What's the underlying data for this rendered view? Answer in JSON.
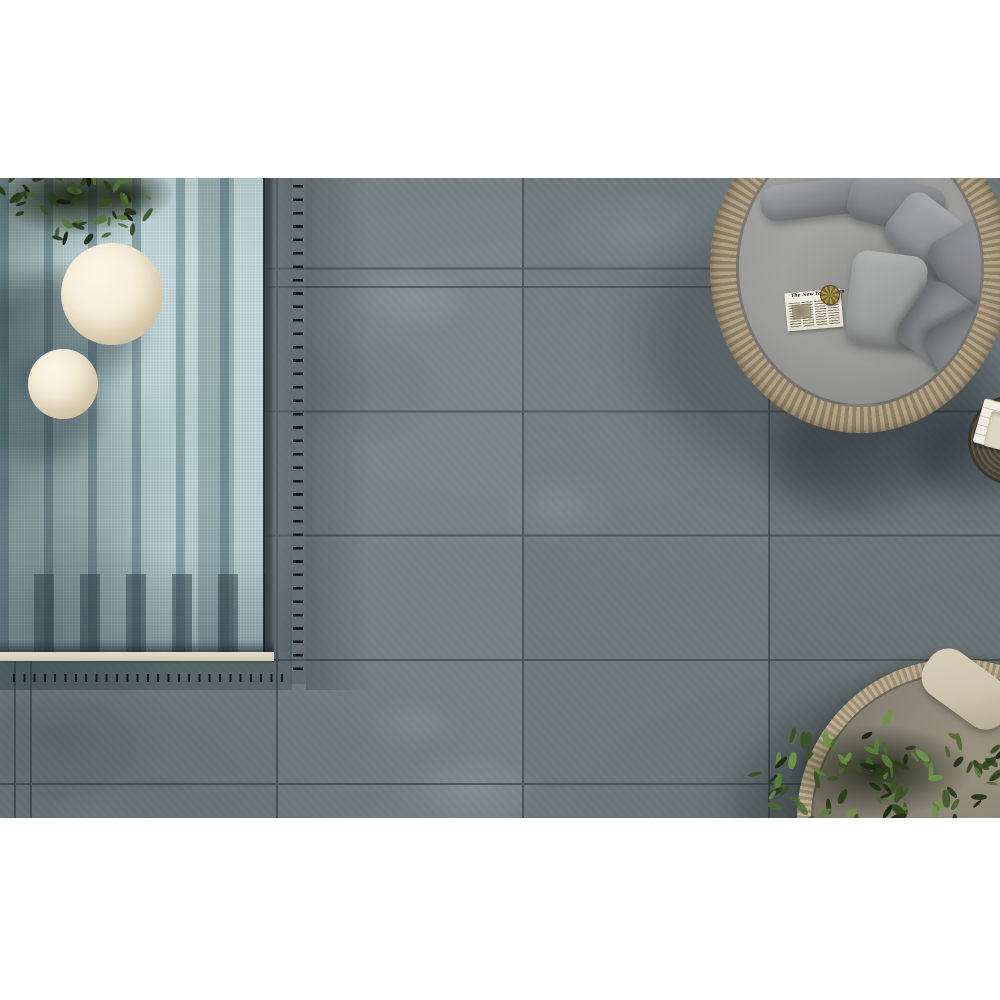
{
  "page": {
    "background": "#ffffff",
    "description": "Top-down photo of an outdoor terrace: grey concrete-look porcelain pavers, mosaic swimming pool with drainage grates, cream sphere lamps, round rattan daybed with grey pillows, rattan side table with towels, planter daybed with olive foliage"
  },
  "newspaper": {
    "masthead": "The New York Times"
  },
  "palette": {
    "page_bg": "#ffffff",
    "tile": "#6d787b",
    "grout": "#3d484c",
    "mosaic_light": "#bdd3d5",
    "mosaic_mid": "#adc7ca",
    "mosaic_deep": "#9fbabe",
    "coping": "#cfc8b2",
    "dash": "#14191c",
    "cream": "#f6edd9",
    "cushion": "#9c9c9a",
    "rattan_light": "#b3a489",
    "rattan_dark": "#8f8067",
    "rattan2_light": "#bcae92",
    "rattan2_dark": "#9c8c70",
    "table_mid": "#665f4e",
    "table_dark": "#4a4539",
    "towel": "#f1ece1",
    "blanket": "#cdc3ae"
  },
  "scene": {
    "pillows": [
      {
        "x": 21,
        "y": 49,
        "w": 112,
        "h": 36,
        "rot": -6,
        "color": "#8c8e91"
      },
      {
        "x": 109,
        "y": 47,
        "w": 96,
        "h": 50,
        "rot": 14,
        "color": "#85888b"
      },
      {
        "x": 149,
        "y": 74,
        "w": 86,
        "h": 60,
        "rot": 38,
        "color": "#96989b"
      },
      {
        "x": 199,
        "y": 89,
        "w": 74,
        "h": 80,
        "rot": 60,
        "color": "#8a8c8f"
      },
      {
        "x": 109,
        "y": 121,
        "w": 76,
        "h": 94,
        "rot": 7,
        "color": "#a0a2a2"
      },
      {
        "x": 174,
        "y": 154,
        "w": 74,
        "h": 92,
        "rot": 125,
        "color": "#8e9093"
      },
      {
        "x": 189,
        "y": 181,
        "w": 76,
        "h": 58,
        "rot": 152,
        "color": "#87898c"
      }
    ],
    "foliage": [
      {
        "id": "foliage-tl",
        "seed": 7,
        "count": 60,
        "cx": 75,
        "cy": 18,
        "rx": 100,
        "ry": 42,
        "lmin": 9,
        "lmax": 16,
        "colors": [
          "#15210e",
          "#1f2e13",
          "#2a3d19",
          "#354d20",
          "#415e28",
          "#527434"
        ]
      },
      {
        "id": "foliage-br",
        "seed": 13,
        "count": 95,
        "cx": 135,
        "cy": 78,
        "rx": 130,
        "ry": 58,
        "lmin": 10,
        "lmax": 18,
        "colors": [
          "#1d2a12",
          "#2b3d19",
          "#3a5222",
          "#4a682c",
          "#5b7f37",
          "#6d9443"
        ]
      }
    ]
  }
}
